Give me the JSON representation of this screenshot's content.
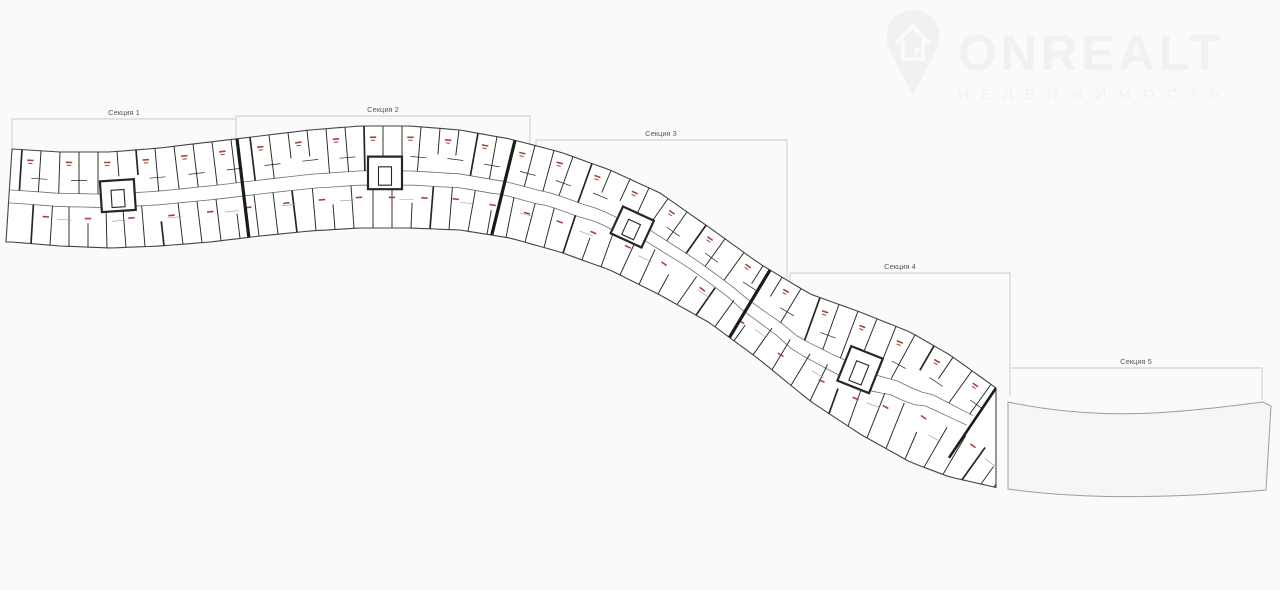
{
  "page": {
    "background": "#fafafb"
  },
  "watermark": {
    "brand": "ONREALT",
    "subtitle": "НЕДВИЖИМОСТЬ",
    "icon": "house-pin-icon",
    "color": "#ececef"
  },
  "plan": {
    "kind": "residential-floor-plan",
    "sections": [
      {
        "label": "Секция 1"
      },
      {
        "label": "Секция 2"
      },
      {
        "label": "Секция 3"
      },
      {
        "label": "Секция 4"
      },
      {
        "label": "Секция 5"
      }
    ],
    "colors": {
      "band_fill": "#ffffff",
      "outline": "#454545",
      "wall": "#262626",
      "wall_light": "#9a9a9a",
      "corridor": "#6e6e6e",
      "divider": "#1b1b1b",
      "unit_label": "#a8433a",
      "bracket": "#c9c9cc",
      "section_label": "#5b5b5b",
      "empty_section_outline": "#9d9da0",
      "empty_section_fill": "#f6f6f8"
    }
  }
}
